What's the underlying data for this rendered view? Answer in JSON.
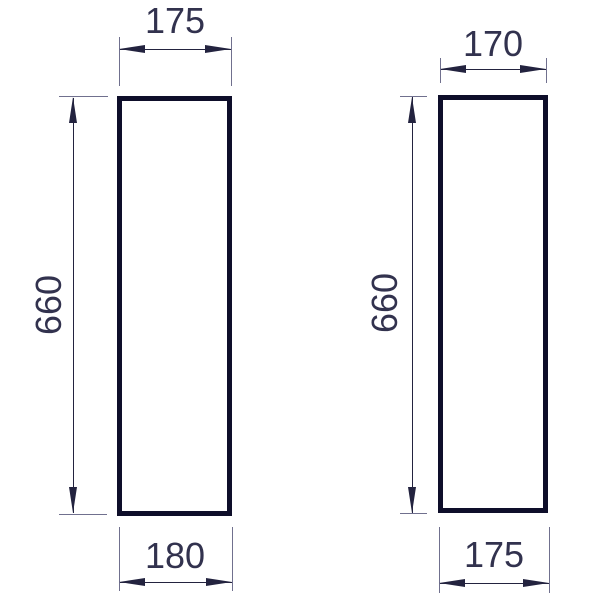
{
  "drawing": {
    "type": "technical-dimension-drawing",
    "colors": {
      "bg": "#ffffff",
      "thick": "#0e0e2a",
      "thin": "#70708e",
      "dim": "#23233f",
      "text": "#32324e"
    },
    "figures": [
      {
        "id": "left-panel-outline",
        "width_top": "175",
        "height_side": "660",
        "width_bottom": "180"
      },
      {
        "id": "right-panel-outline",
        "width_top": "170",
        "height_side": "660",
        "width_bottom": "175"
      }
    ]
  }
}
